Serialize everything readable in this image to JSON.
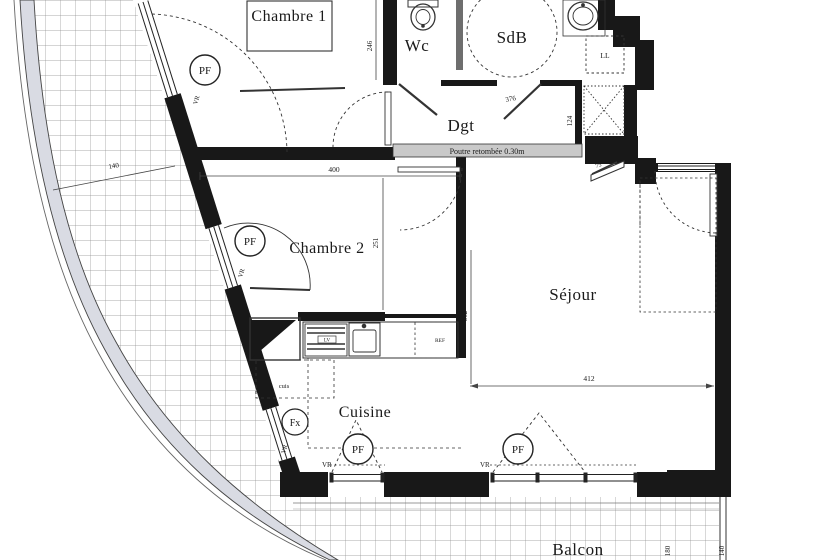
{
  "plan": {
    "title": "apartment-floor-plan",
    "rooms": {
      "chambre1": "Chambre 1",
      "wc": "Wc",
      "sdb": "SdB",
      "dgt": "Dgt",
      "chambre2": "Chambre 2",
      "sejour": "Séjour",
      "cuisine": "Cuisine",
      "balcon": "Balcon"
    },
    "labels": {
      "beam": "Poutre retombée 0.30m",
      "ll": "LL",
      "ref": "REF",
      "lv": "LV",
      "cuis": "cuis"
    },
    "symbols": {
      "pf": "PF",
      "fx": "Fx",
      "vr": "VR"
    },
    "dims": {
      "d246": "246",
      "d376": "376",
      "d124": "124",
      "d400": "400",
      "d251": "251",
      "d362": "362",
      "d412": "412",
      "d140": "140",
      "d75": "75",
      "d180": "180",
      "d140b": "140"
    },
    "colors": {
      "wall": "#181818",
      "paper": "#ffffff",
      "terrace_band": "#d9dbe3",
      "beam_band": "#c9c9c9",
      "tile_grid": "#8f8f8f"
    }
  }
}
